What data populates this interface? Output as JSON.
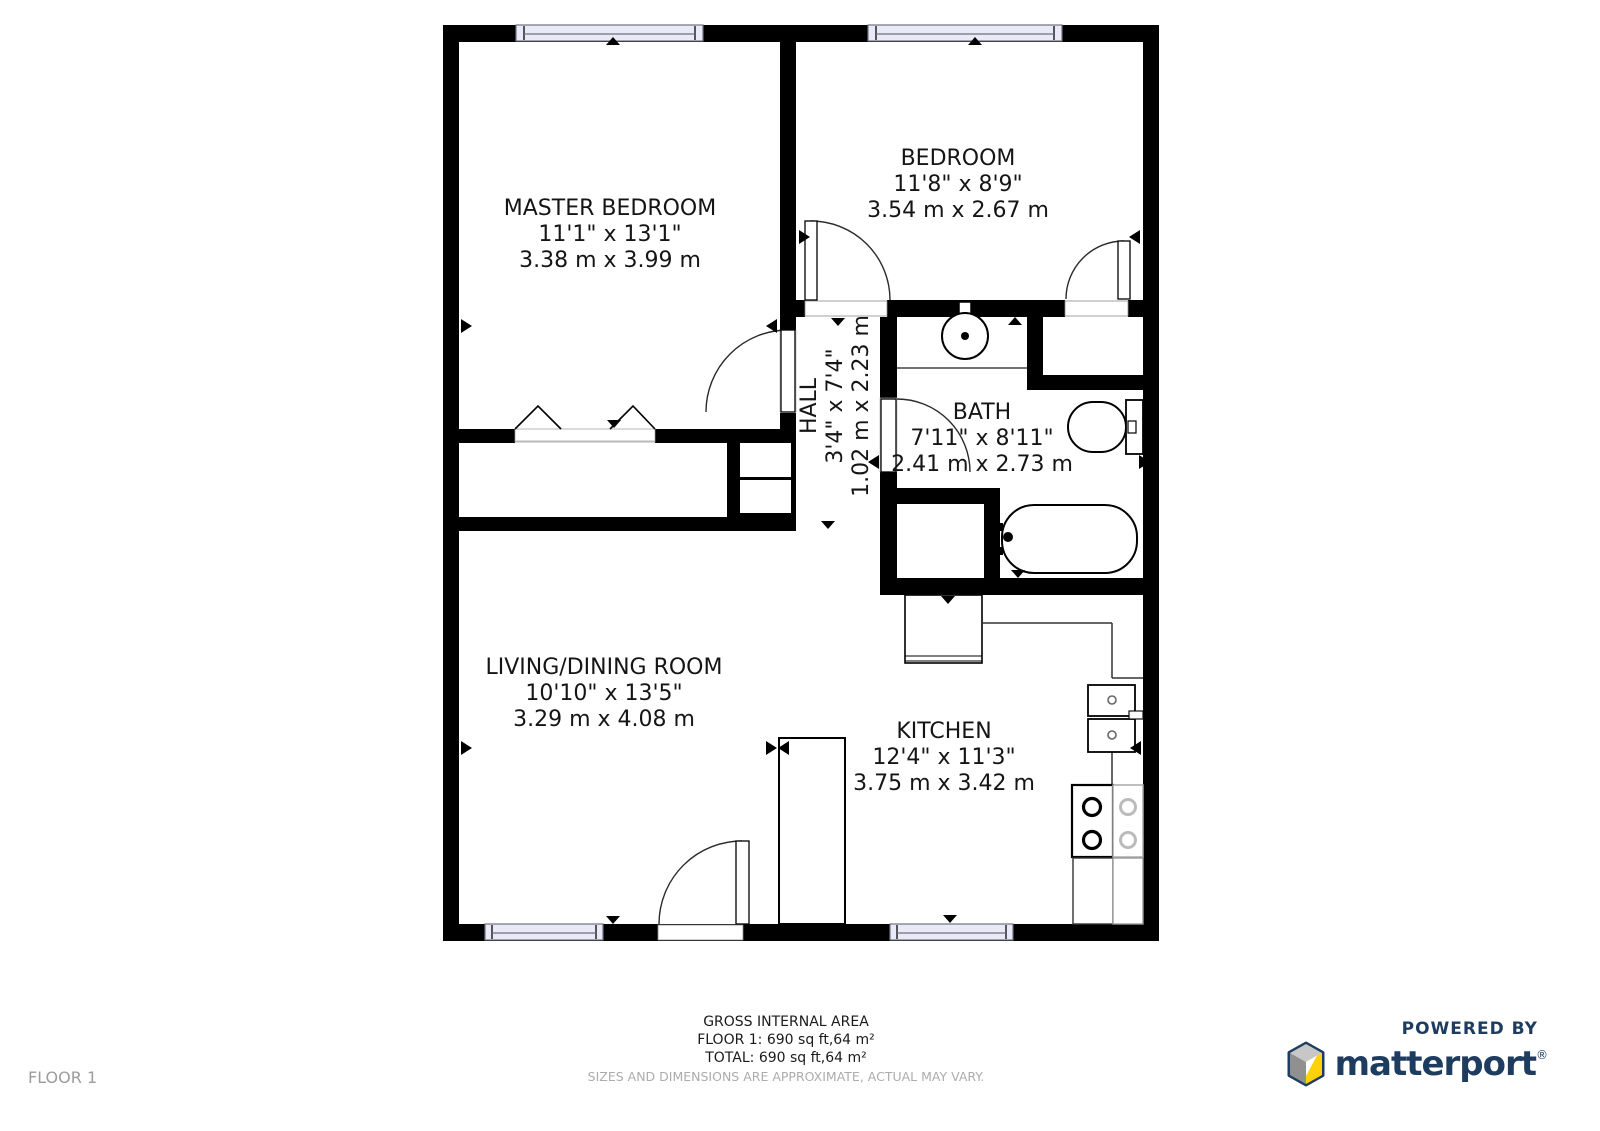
{
  "floor_label": "FLOOR 1",
  "rooms": [
    {
      "name": "MASTER BEDROOM",
      "imperial": "11'1\" x 13'1\"",
      "metric": "3.38 m x 3.99 m"
    },
    {
      "name": "BEDROOM",
      "imperial": "11'8\" x 8'9\"",
      "metric": "3.54 m x 2.67 m"
    },
    {
      "name": "HALL",
      "imperial": "3'4\" x 7'4\"",
      "metric": "1.02 m x 2.23 m"
    },
    {
      "name": "BATH",
      "imperial": "7'11\" x 8'11\"",
      "metric": "2.41 m x 2.73 m"
    },
    {
      "name": "LIVING/DINING ROOM",
      "imperial": "10'10\" x 13'5\"",
      "metric": "3.29 m x 4.08 m"
    },
    {
      "name": "KITCHEN",
      "imperial": "12'4\" x 11'3\"",
      "metric": "3.75 m x 3.42 m"
    }
  ],
  "footer": {
    "line1": "GROSS INTERNAL AREA",
    "line2": "FLOOR 1: 690 sq ft,64 m²",
    "line3": "TOTAL: 690 sq ft,64 m²",
    "disclaimer": "SIZES AND DIMENSIONS ARE APPROXIMATE, ACTUAL MAY VARY."
  },
  "branding": {
    "powered_by": "POWERED BY",
    "brand": "matterport",
    "registered": "®"
  },
  "fixtures": [
    "bathroom-sink",
    "toilet",
    "bathtub",
    "kitchen-sink",
    "stove",
    "refrigerator",
    "closet-bifold-doors",
    "windows",
    "door-swings"
  ],
  "colors": {
    "wall": "#000000",
    "window_fill": "#E9E9F7",
    "window_frame": "#70707E",
    "label_text": "#151515",
    "muted_text": "#9C9C9C",
    "brand_navy": "#1D3C5F",
    "brand_yellow": "#FFD10A",
    "brand_gray_light": "#C7C7C7",
    "brand_gray_dark": "#909090"
  }
}
